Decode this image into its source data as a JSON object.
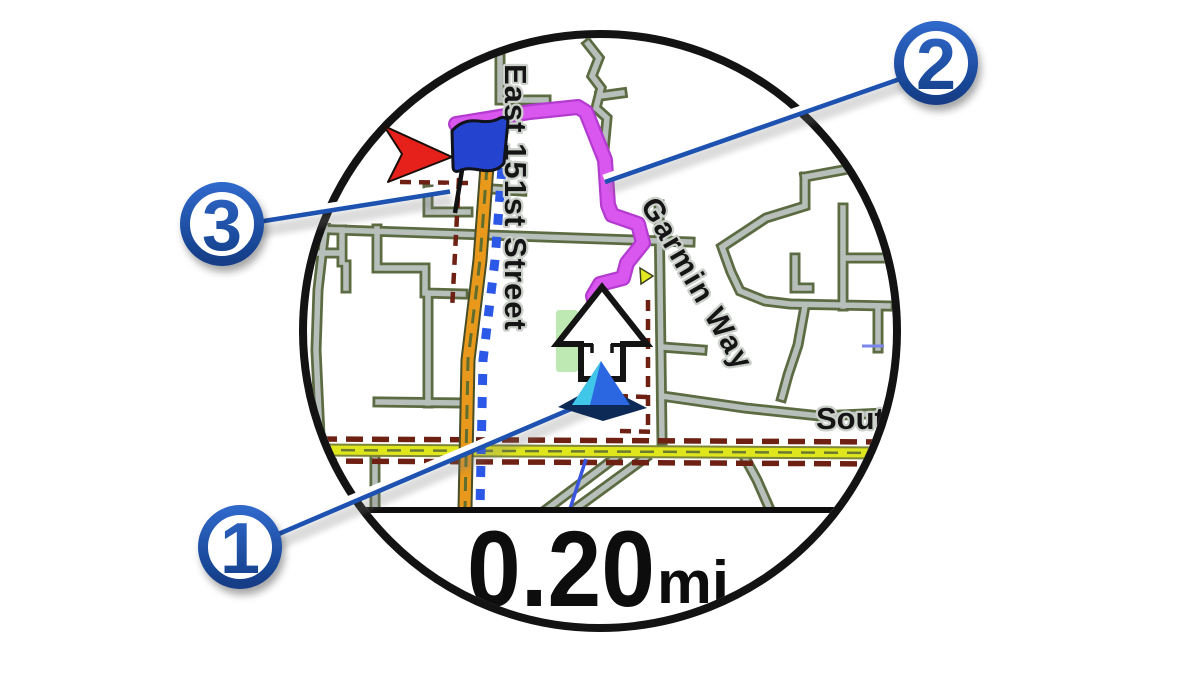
{
  "device_screen": {
    "screen_type": "watch navigation map",
    "data_field": {
      "distance": "0.20",
      "unit": "mi"
    }
  },
  "map": {
    "labels": [
      {
        "text": "East 151st Street"
      },
      {
        "text": "Garmin Way"
      },
      {
        "text": "Sout"
      }
    ]
  },
  "callouts": [
    {
      "number": "1"
    },
    {
      "number": "2"
    },
    {
      "number": "3"
    }
  ],
  "icons": [
    {
      "name": "current-location-icon",
      "shape": "blue triangle marker"
    },
    {
      "name": "next-turn-arrow-icon",
      "shape": "white outlined up arrow"
    },
    {
      "name": "destination-flag-icon",
      "shape": "blue flag on pole"
    },
    {
      "name": "destination-pointer-icon",
      "shape": "red arrow"
    }
  ],
  "colors": {
    "callout_blue": "#1d52b0",
    "route_magenta": "#d24fe8",
    "road_orange": "#e8991c",
    "road_yellow": "#e0e61c",
    "street_gray": "#b7bfbb",
    "street_casing_olive": "#5c6b42",
    "boundary_dark_red": "#6e2113",
    "course_blue_dash": "#2c58e8",
    "location_blue": "#2c67e2",
    "pointer_red": "#e6211c"
  }
}
